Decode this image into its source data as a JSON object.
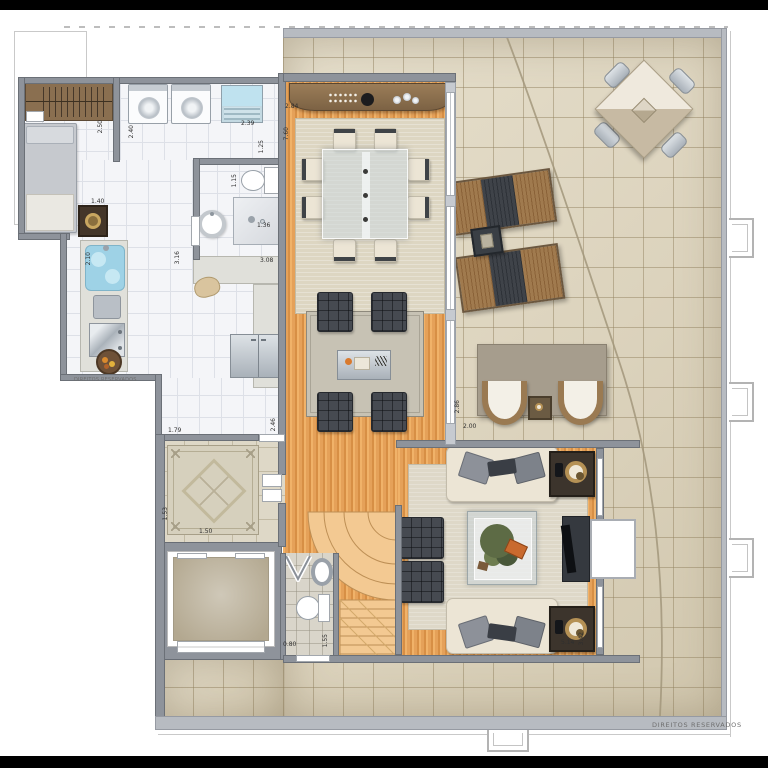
{
  "watermarks": {
    "left": "DIREITOS RESERVADOS",
    "bottom_right": "DIREITOS RESERVADOS"
  },
  "dims": {
    "d250": "2.50",
    "d240": "2.40",
    "d239": "2.39",
    "d125": "1.25",
    "d140": "1.40",
    "d115": "1.15",
    "d136": "1.36",
    "d210": "2.10",
    "d316": "3.16",
    "d308": "3.08",
    "d284": "2.84",
    "d760": "7.60",
    "d179": "1.79",
    "d246": "2.46",
    "d153": "1.53",
    "d150": "1.50",
    "d080": "0.80",
    "d155": "1.55",
    "d514": "5.14",
    "d342": "3.42",
    "d286": "2.86",
    "d200": "2.00"
  },
  "colors": {
    "wood_floor": "#e5a159",
    "terrace_tile": "#ddd4be",
    "indoor_tile": "#f4f5f8",
    "wall_dark": "#8e939b",
    "wall_light": "#b7bbc1",
    "furniture_charcoal": "#464a51",
    "sofa_cream": "#ece5d5",
    "cabinet_brown": "#8b6f4e",
    "water_blue": "#9ed2e6"
  }
}
